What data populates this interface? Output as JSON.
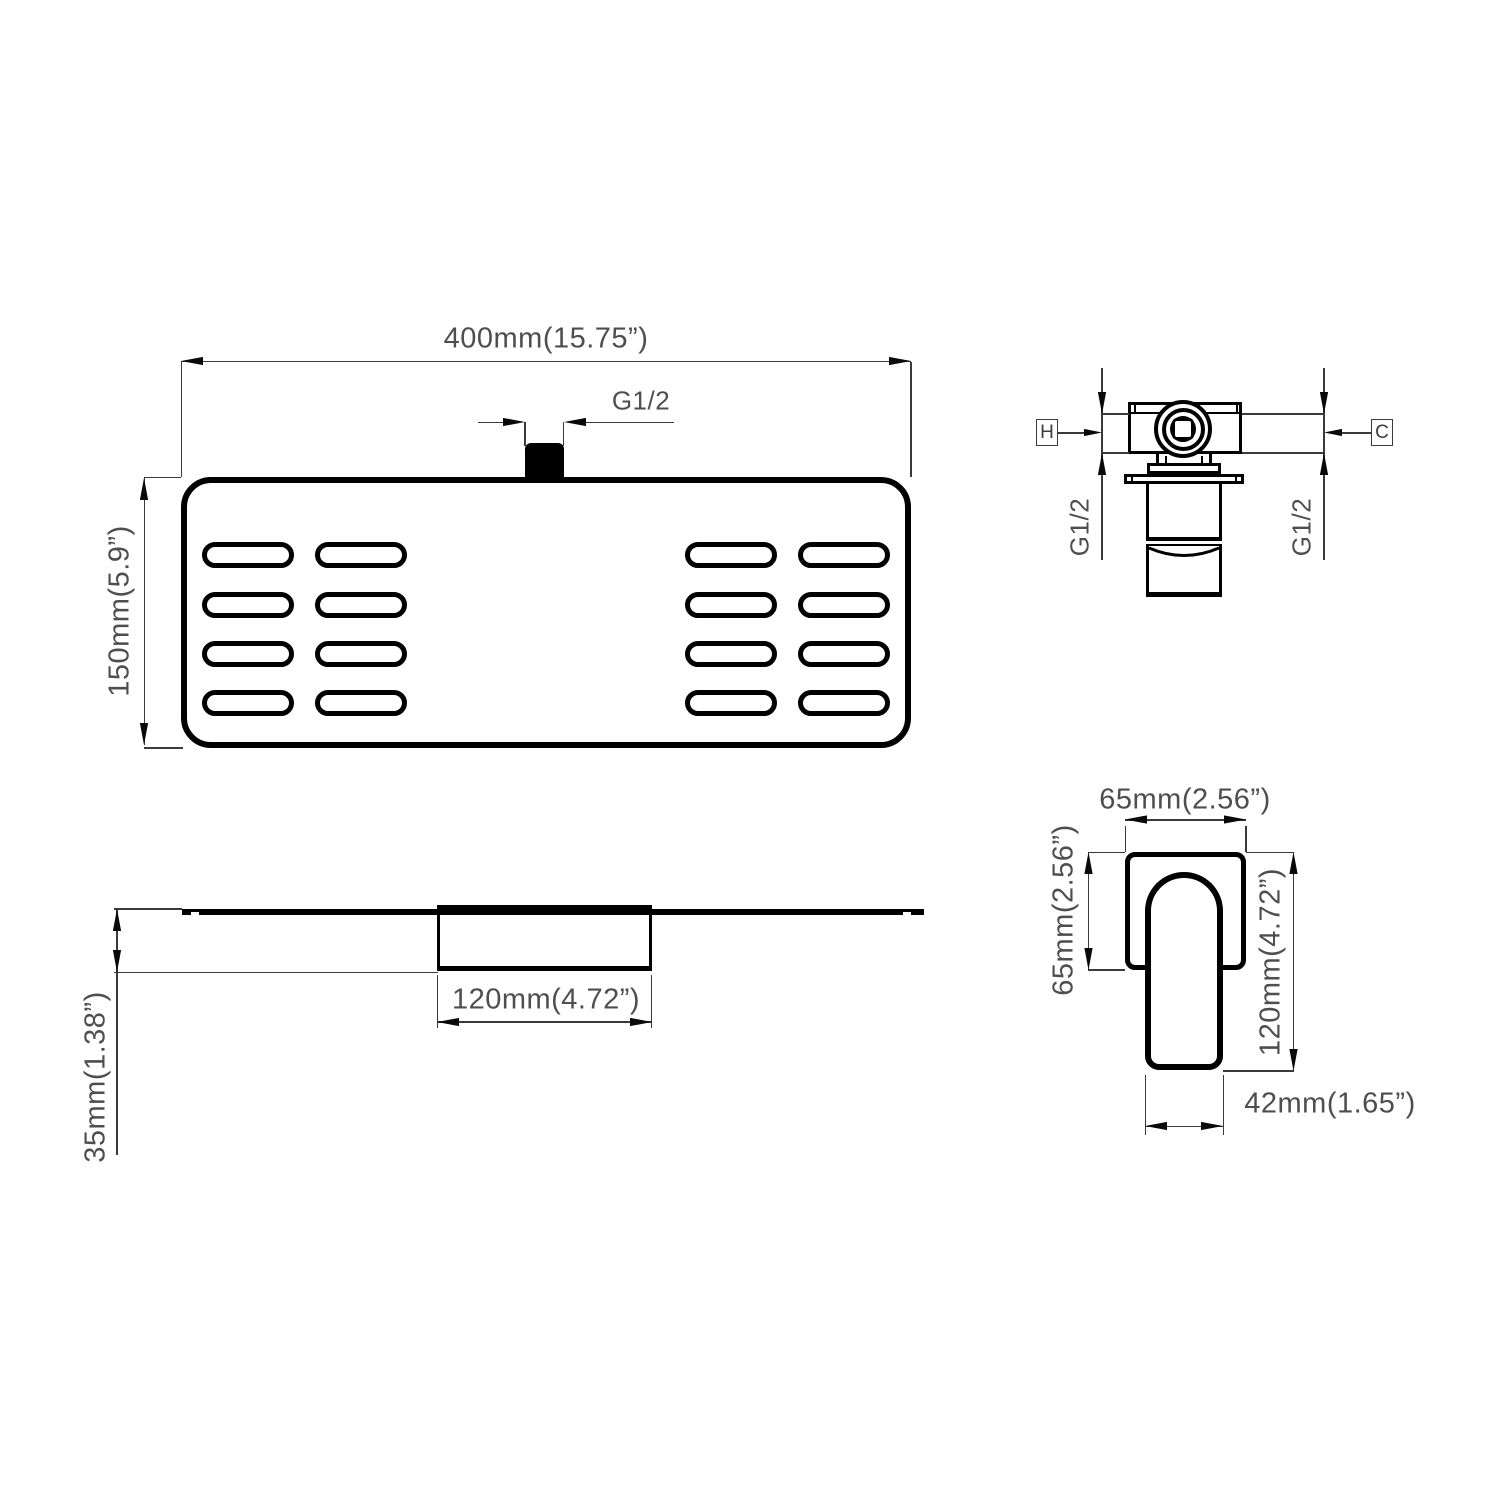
{
  "head_top_view": {
    "width_label": "400mm(15.75”)",
    "height_label": "150mm(5.9”)",
    "thread_label": "G1/2"
  },
  "valve_view": {
    "hot_label": "H",
    "cold_label": "C",
    "thread_left_label": "G1/2",
    "thread_right_label": "G1/2"
  },
  "head_side_view": {
    "bracket_width_label": "120mm(4.72”)",
    "thickness_label": "35mm(1.38”)"
  },
  "handle_view": {
    "plate_width_label": "65mm(2.56”)",
    "plate_height_label": "65mm(2.56”)",
    "total_height_label": "120mm(4.72”)",
    "handle_width_label": "42mm(1.65”)"
  },
  "colors": {
    "object_line": "#000000",
    "dimension_line": "#3a3a3a",
    "text": "#4e4e4e"
  }
}
